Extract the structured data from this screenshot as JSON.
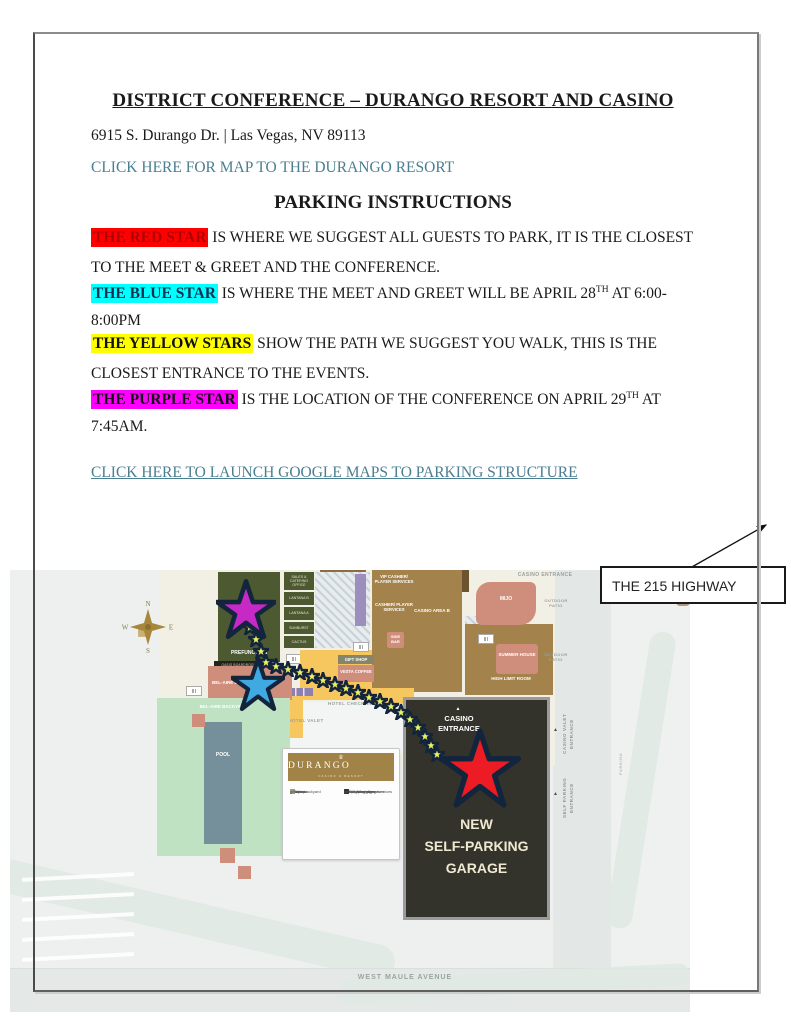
{
  "page": {
    "title": "DISTRICT CONFERENCE – DURANGO RESORT AND CASINO",
    "address": "6915 S. Durango Dr. | Las Vegas, NV 89113",
    "map_link": "CLICK HERE FOR MAP TO THE DURANGO RESORT",
    "subtitle": "PARKING INSTRUCTIONS",
    "link_color": "#4a7e91",
    "paragraphs": [
      {
        "hl": "THE RED STAR",
        "c_bg": "#ff0000",
        "c_fg": "#b00000",
        "t1": " IS WHERE WE SUGGEST ALL GUESTS TO PARK, IT IS THE CLOSEST TO THE MEET & GREET AND THE CONFERENCE.",
        "sup": "",
        "t2": ""
      },
      {
        "hl": "THE BLUE STAR",
        "c_bg": "#00ffff",
        "c_fg": "#0b3050",
        "t1": " IS WHERE THE MEET AND GREET WILL BE APRIL 28",
        "sup": "TH",
        "t2": " AT 6:00-8:00PM"
      },
      {
        "hl": "THE YELLOW STARS",
        "c_bg": "#ffff00",
        "c_fg": "#111111",
        "t1": " SHOW THE PATH WE SUGGEST YOU WALK, THIS IS THE CLOSEST ENTRANCE TO THE EVENTS.",
        "sup": "",
        "t2": ""
      },
      {
        "hl": "THE PURPLE STAR",
        "c_bg": "#ff00ff",
        "c_fg": "#111111",
        "t1": " IS THE LOCATION OF THE CONFERENCE ON APRIL 29",
        "sup": "TH",
        "t2": " AT 7:45AM.",
        "t3": ""
      }
    ],
    "parking_link": "CLICK HERE TO LAUNCH GOOGLE MAPS TO PARKING STRUCTURE",
    "highway_label": "THE 215 HIGHWAY"
  },
  "map": {
    "compass": {
      "n": "N",
      "e": "E",
      "s": "S",
      "w": "W"
    },
    "icons": {
      "triangle": "▲"
    },
    "labels": {
      "prefunction": "PREFUNCTION",
      "boardroom": "OASIS BOARDROOM",
      "rooms": [
        "SALES & CATERING OFFICE",
        "LANTANA B",
        "LANTANA A",
        "SUNBURST",
        "CACTUS"
      ],
      "vip_cashier": "VIP CASHIER/ PLAYER SERVICES",
      "cashier": "CASHIER/ PLAYER SERVICES",
      "casino_area": "CASINO AREA B",
      "side_bar": "SIDE BAR",
      "mijo": "MIJO",
      "casino_entrance_top": "CASINO ENTRANCE",
      "outdoor_patio": "OUTDOOR PATIO",
      "summer_house": "SUMMER HOUSE",
      "high_limit": "HIGH LIMIT ROOM",
      "gift_shop": "GIFT SHOP",
      "vesta": "VESTA COFFEE",
      "bel_aire_ballroom": "BEL-AIRE BALLROOM",
      "bel_aire_backyard": "BEL-AIRE BACKYARD",
      "pool": "POOL",
      "hotel_checkin": "HOTEL CHECK-IN",
      "hotel_valet": "HOTEL VALET",
      "hotel": "HOTEL",
      "garage_entrance_l1": "CASINO",
      "garage_entrance_l2": "ENTRANCE",
      "garage_l1": "NEW",
      "garage_l2": "SELF-PARKING",
      "garage_l3": "GARAGE",
      "casino_valet_l1": "CASINO VALET",
      "casino_valet_l2": "ENTRANCE",
      "self_parking_l1": "SELF PARKING",
      "self_parking_l2": "ENTRANCE",
      "parking_side": "PARKING",
      "street": "WEST MAULE AVENUE"
    },
    "legend": {
      "brand": "DURANGO",
      "brand_sub": "CASINO & RESORT",
      "left": [
        {
          "label": "restrooms",
          "color": "icon"
        },
        {
          "label": "elevators",
          "color": "#b3bcbf"
        },
        {
          "label": "lobby",
          "color": "#f6c75f"
        },
        {
          "label": "ballroom",
          "color": "#4d5930"
        },
        {
          "label": "bel-aire backyard",
          "color": "#bfe2c3"
        },
        {
          "label": "pool",
          "color": "#76909b"
        },
        {
          "label": "gift shop",
          "color": "#9c9c8a"
        }
      ],
      "right": [
        {
          "label": "food & beverage",
          "color": "#cf8d7c"
        },
        {
          "label": "gaming amenities",
          "color": "#a3824c"
        },
        {
          "label": "cashier/player services",
          "color": "#9c8fbd"
        },
        {
          "label": "VIP cashier/player services",
          "color": "#5a5270"
        },
        {
          "label": "self-parking garage",
          "color": "#33332b"
        }
      ]
    },
    "star_colors": {
      "red": "#ed1c24",
      "blue": "#3fa9e1",
      "purple": "#c629c6",
      "path_yellow": "#e9f161",
      "outline": "#13253c"
    }
  }
}
